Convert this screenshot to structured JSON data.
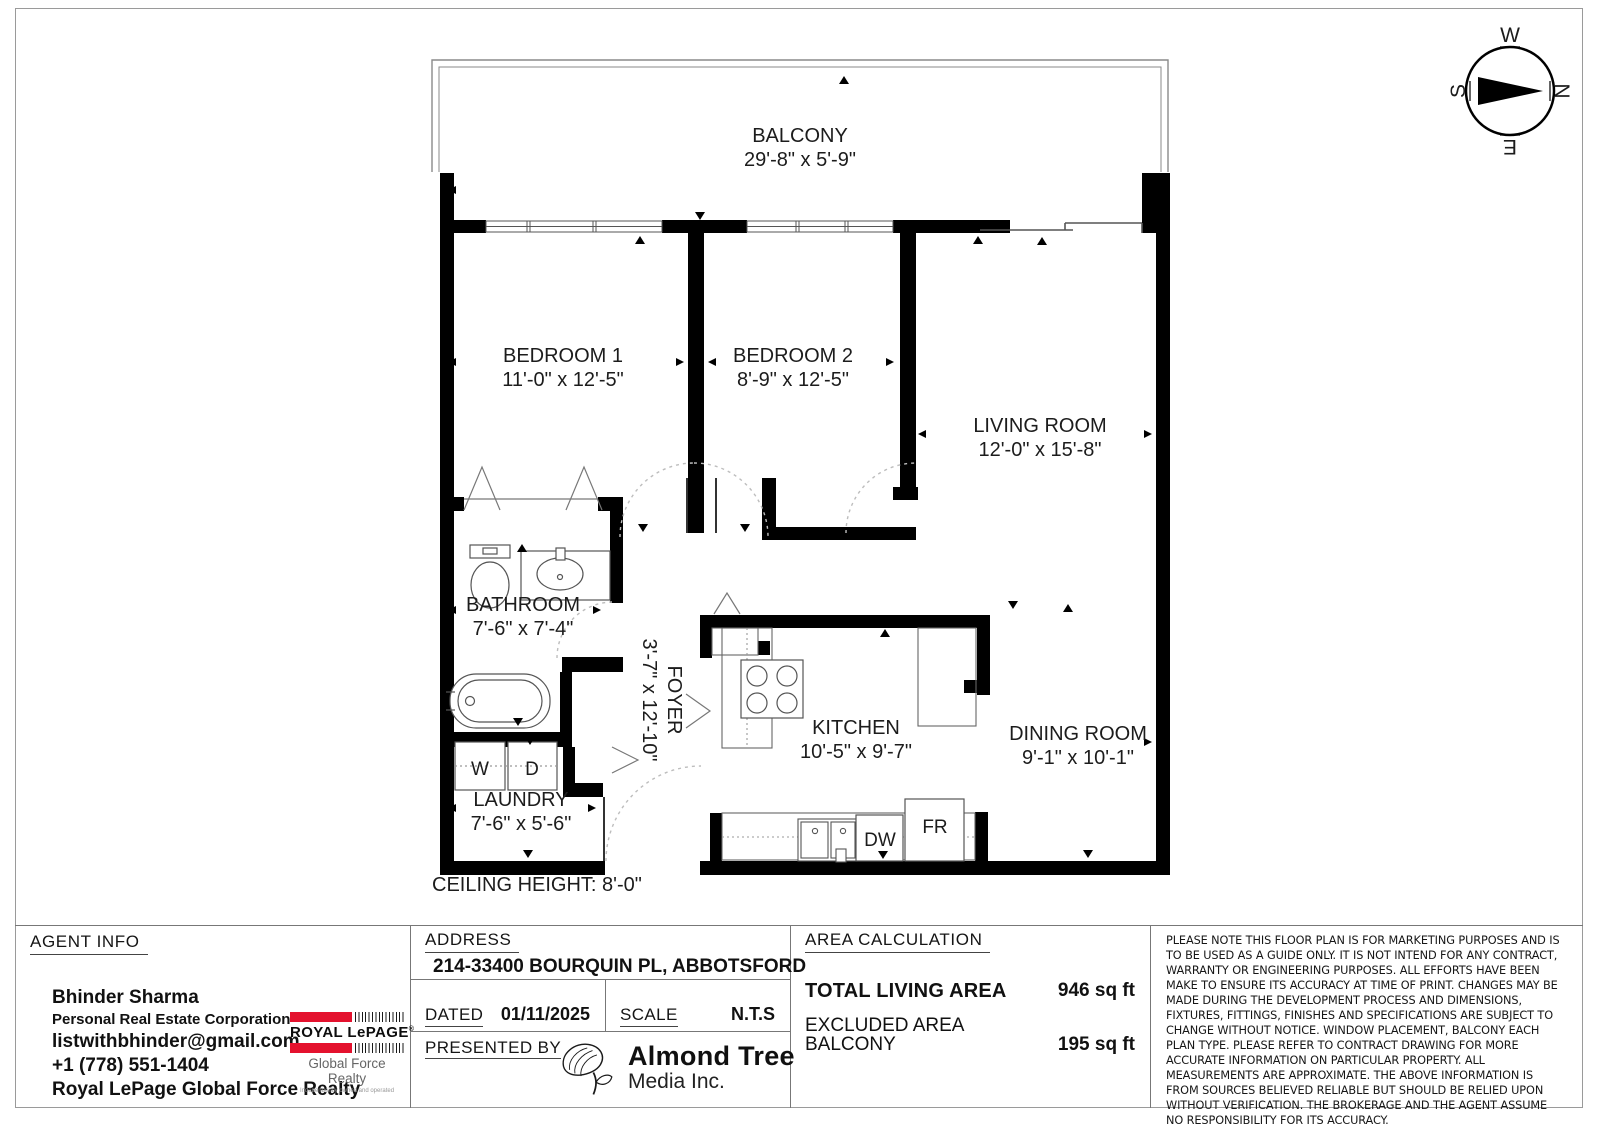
{
  "plan": {
    "rooms": {
      "balcony": {
        "name": "BALCONY",
        "dims": "29'-8\" x 5'-9\""
      },
      "bedroom1": {
        "name": "BEDROOM 1",
        "dims": "11'-0\" x 12'-5\""
      },
      "bedroom2": {
        "name": "BEDROOM 2",
        "dims": "8'-9\" x 12'-5\""
      },
      "living": {
        "name": "LIVING ROOM",
        "dims": "12'-0\" x 15'-8\""
      },
      "dining": {
        "name": "DINING ROOM",
        "dims": "9'-1\" x 10'-1\""
      },
      "kitchen": {
        "name": "KITCHEN",
        "dims": "10'-5\" x 9'-7\""
      },
      "bathroom": {
        "name": "BATHROOM",
        "dims": "7'-6\" x 7'-4\""
      },
      "foyer": {
        "name": "FOYER",
        "dims": "3'-7\" x 12'-10\""
      },
      "laundry": {
        "name": "LAUNDRY",
        "dims": "7'-6\" x 5'-6\""
      }
    },
    "labels": {
      "washer": "W",
      "dryer": "D",
      "dishwasher": "DW",
      "fridge": "FR"
    },
    "ceiling_note": "CEILING HEIGHT:  8'-0\""
  },
  "compass": {
    "north": "N",
    "south": "S",
    "east": "E",
    "west": "W"
  },
  "panel": {
    "agent": {
      "title": "AGENT INFO",
      "name": "Bhinder Sharma",
      "line2": "Personal Real Estate Corporation",
      "email": "listwithbhinder@gmail.com",
      "phone": "+1 (778) 551-1404",
      "brokerage": "Royal LePage Global Force Realty"
    },
    "brand": {
      "name": "ROYAL LePAGE",
      "reg": "®",
      "sub": "Global Force Realty",
      "tagline": "Independently owned and operated"
    },
    "address": {
      "title": "ADDRESS",
      "value": "214-33400 BOURQUIN PL, ABBOTSFORD",
      "dated_label": "DATED",
      "dated_value": "01/11/2025",
      "scale_label": "SCALE",
      "scale_value": "N.T.S",
      "presented_label": "PRESENTED BY"
    },
    "media": {
      "line1": "Almond Tree",
      "line2": "Media Inc."
    },
    "area": {
      "title": "AREA CALCULATION",
      "total_label": "TOTAL LIVING AREA",
      "total_value": "946 sq ft",
      "excluded_label": "EXCLUDED AREA",
      "balcony_label": "BALCONY",
      "balcony_value": "195 sq ft"
    },
    "disclaimer": "PLEASE NOTE THIS FLOOR PLAN IS FOR MARKETING PURPOSES AND IS TO BE USED AS A GUIDE ONLY. IT IS NOT INTEND FOR ANY CONTRACT, WARRANTY OR ENGINEERING PURPOSES. ALL EFFORTS HAVE BEEN MAKE TO ENSURE ITS ACCURACY AT TIME OF PRINT. CHANGES MAY BE MADE DURING THE DEVELOPMENT PROCESS AND DIMENSIONS, FIXTURES, FITTINGS, FINISHES AND SPECIFICATIONS ARE SUBJECT TO CHANGE WITHOUT NOTICE. WINDOW PLACEMENT, BALCONY EACH PLAN TYPE. PLEASE REFER TO CONTRACT DRAWING FOR MORE ACCURATE INFORMATION ON PARTICULAR PROPERTY. ALL MEASUREMENTS ARE APPROXIMATE. THE ABOVE INFORMATION IS FROM SOURCES BELIEVED RELIABLE BUT SHOULD BE RELIED UPON WITHOUT VERIFICATION. THE BROKERAGE AND THE AGENT ASSUME NO RESPONSIBILITY FOR ITS ACCURACY."
  },
  "colors": {
    "brand_red": "#e4122e",
    "wall": "#000000"
  }
}
